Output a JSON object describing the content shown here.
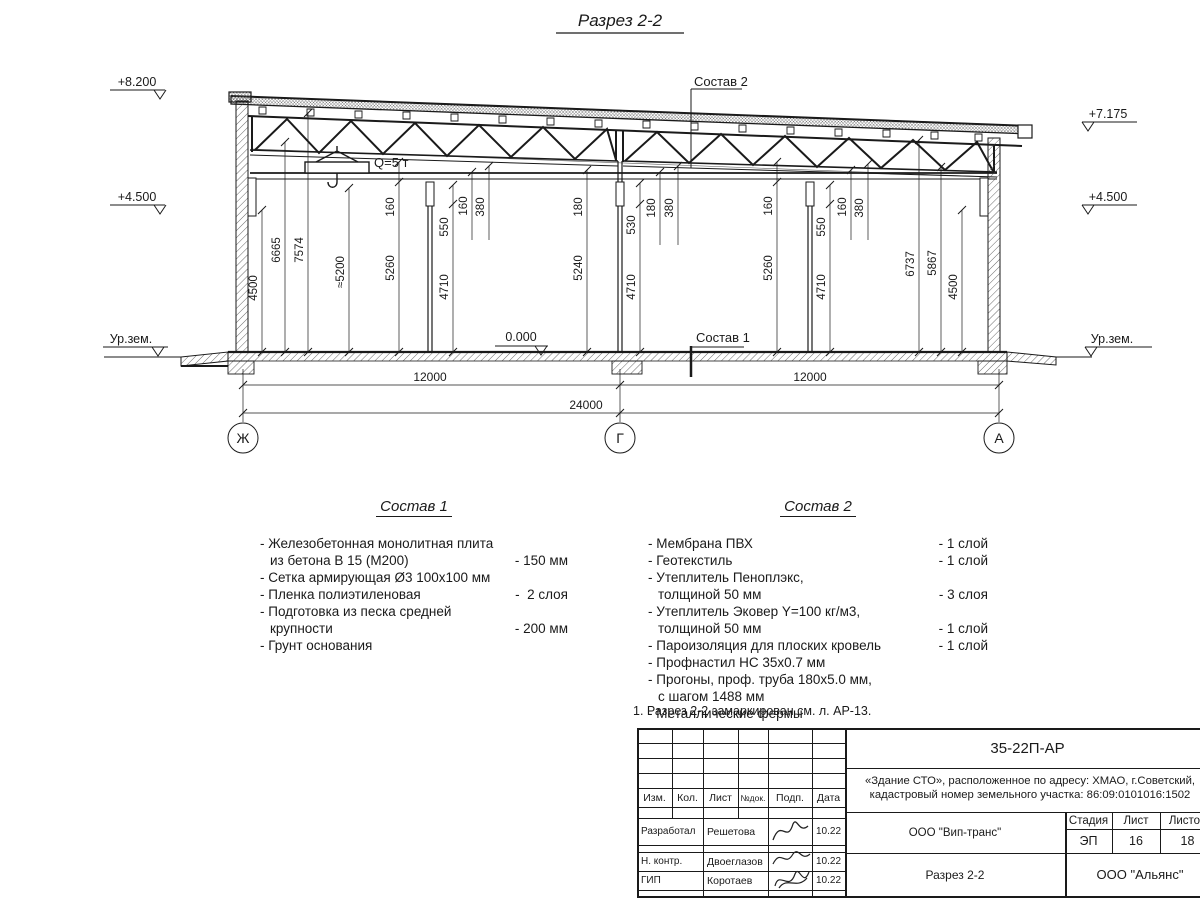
{
  "title": "Разрез 2-2",
  "drawing": {
    "elevations": {
      "left_top": "+8.200",
      "left_mid": "+4.500",
      "right_top": "+7.175",
      "right_mid": "+4.500",
      "ground_left": "Ур.зем.",
      "ground_right": "Ур.зем.",
      "zero": "0.000"
    },
    "labels": {
      "sostav1_callout": "Состав 1",
      "sostav2_callout": "Состав 2",
      "crane": "Q=5 т"
    },
    "vdims": [
      "4500",
      "6665",
      "7574",
      "≈5200",
      "160",
      "5260",
      "550",
      "4710",
      "160",
      "380",
      "180",
      "5240",
      "530",
      "4710",
      "180",
      "380",
      "160",
      "5260",
      "550",
      "4710",
      "160",
      "380",
      "6737",
      "5867",
      "4500"
    ],
    "hdims": [
      "12000",
      "12000",
      "24000"
    ],
    "axes": [
      "Ж",
      "Г",
      "А"
    ]
  },
  "sostav1": {
    "title": "Состав 1",
    "items": [
      {
        "l1": "- Железобетонная  монолитная плита",
        "l2": "из бетона В 15 (М200)",
        "value": "- 150 мм"
      },
      {
        "l1": "- Сетка армирующая Ø3 100х100 мм",
        "l2": "",
        "value": ""
      },
      {
        "l1": "- Пленка полиэтиленовая",
        "l2": "",
        "value": "-  2 слоя"
      },
      {
        "l1": "- Подготовка из песка средней",
        "l2": "крупности",
        "value": "- 200 мм"
      },
      {
        "l1": "- Грунт основания",
        "l2": "",
        "value": ""
      }
    ]
  },
  "sostav2": {
    "title": "Состав 2",
    "items": [
      {
        "l1": "- Мембрана ПВХ",
        "l2": "",
        "value": "- 1 слой"
      },
      {
        "l1": "- Геотекстиль",
        "l2": "",
        "value": "- 1 слой"
      },
      {
        "l1": "- Утеплитель Пеноплэкс,",
        "l2": "толщиной 50 мм",
        "value": "- 3 слоя"
      },
      {
        "l1": "- Утеплитель Эковер Y=100 кг/м3,",
        "l2": "толщиной 50 мм",
        "value": "- 1 слой"
      },
      {
        "l1": "- Пароизоляция для плоских кровель",
        "l2": "",
        "value": "- 1 слой"
      },
      {
        "l1": "- Профнастил НС 35х0.7 мм",
        "l2": "",
        "value": ""
      },
      {
        "l1": "- Прогоны, проф. труба 180х5.0 мм,",
        "l2": "с шагом 1488 мм",
        "value": ""
      },
      {
        "l1": "- Металлические фермы",
        "l2": "",
        "value": ""
      }
    ]
  },
  "note": "1. Разрез 2-2 замаркирован см. л. АР-13.",
  "stamp": {
    "doc_number": "35-22П-АР",
    "object_line1": "«Здание СТО», расположенное по адресу: ХМАО, г.Советский,",
    "object_line2": "кадастровый номер земельного участка: 86:09:0101016:1502",
    "cols": {
      "c1": "Изм.",
      "c2": "Кол.",
      "c3": "Лист",
      "c4": "№док.",
      "c5": "Подп.",
      "c6": "Дата"
    },
    "rows": {
      "r1_role": "Разработал",
      "r1_name": "Решетова",
      "r1_date": "10.22",
      "r2_role": "Н. контр.",
      "r2_name": "Двоеглазов",
      "r2_date": "10.22",
      "r3_role": "ГИП",
      "r3_name": "Коротаев",
      "r3_date": "10.22"
    },
    "company": "ООО \"Вип-транс\"",
    "stage_label": "Стадия",
    "sheet_label": "Лист",
    "sheets_label": "Листов",
    "stage": "ЭП",
    "sheet": "16",
    "sheets": "18",
    "section_title": "Разрез 2-2",
    "org": "ООО \"Альянс\""
  }
}
